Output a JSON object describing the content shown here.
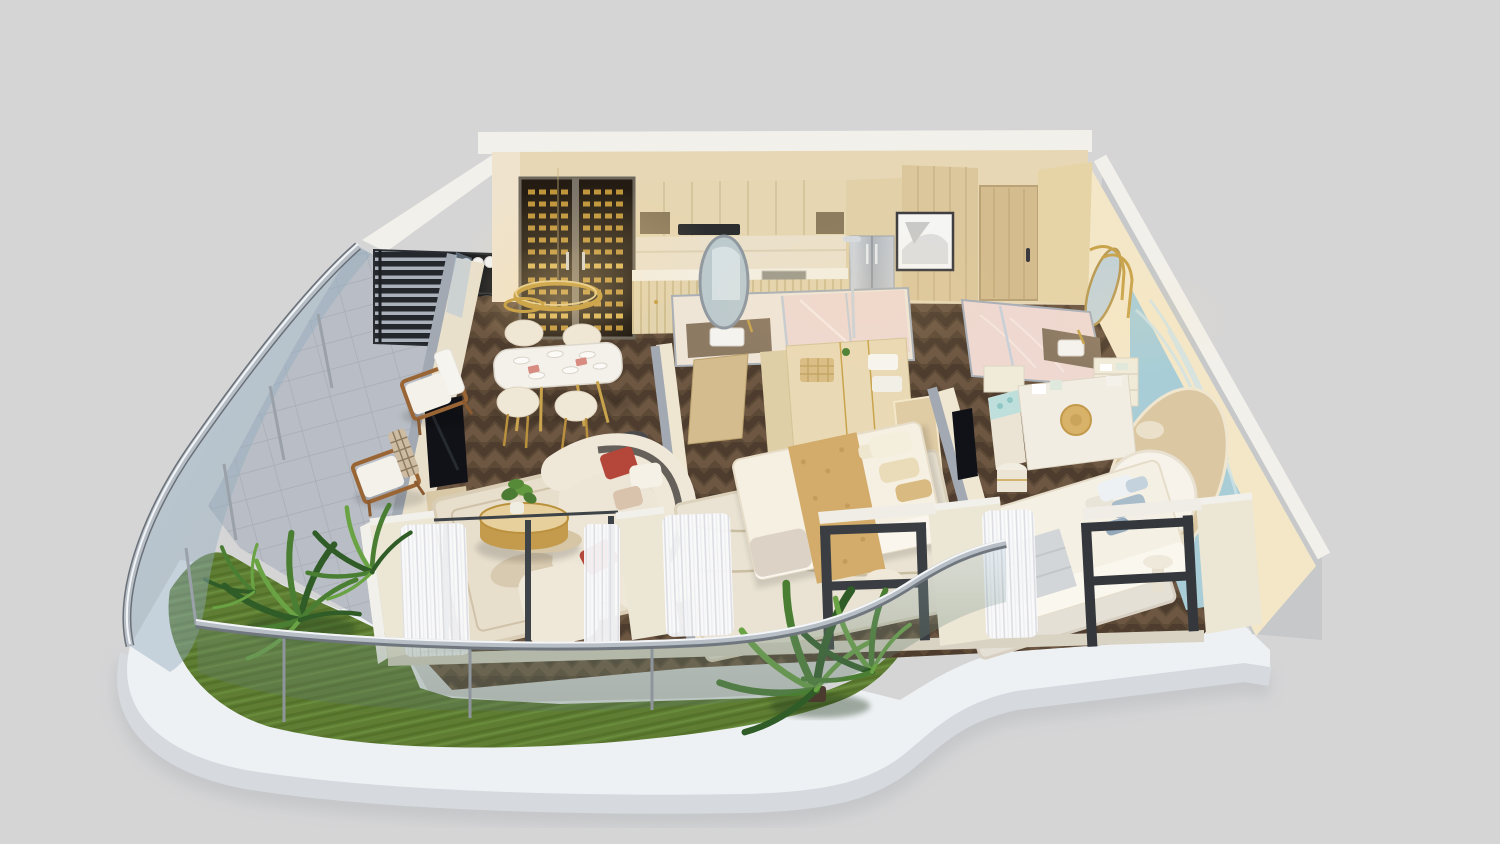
{
  "meta": {
    "title": "Isometric 3D cutaway floor plan render of a two-bedroom apartment with wraparound balcony",
    "canvas": {
      "width": 1500,
      "height": 844
    },
    "style": "photorealistic dollhouse render on plain grey studio background",
    "text_content": "none — image contains no visible text, labels or UI controls"
  },
  "colors": {
    "bg": "#d5d5d6",
    "platform_top": "#eef1f4",
    "platform_face": "#d6dadf",
    "platform_shadow": "#b9bcc0",
    "lawn_green": "#5f7e34",
    "tile_grey": "#b9bdc5",
    "parquet_dark": "#5c4936",
    "parquet_light": "#6d5742",
    "wall_cream": "#ece6d5",
    "wall_cap_grey": "#a3a9b2",
    "wall_top_white": "#f2f0ea",
    "wood_cabinet": "#e6d6b1",
    "wood_door": "#d4bc8e",
    "travertine": "#ebe0ca",
    "wine_gold": "#c89b3c",
    "brass": "#c9a44c",
    "chrome": "#b7bec6",
    "frame_dark": "#3a3d41",
    "glass_blue": "#a7c0d4",
    "sofa_cream": "#efe8d9",
    "accent_rust": "#b5463a",
    "rug_cream": "#e7decc",
    "linen_white": "#f6f0e3",
    "throw_gold": "#d3ac6b",
    "pillow_blue": "#a9bcca",
    "art_blue": "#a8cdd7",
    "art_arch": "#dbc8a2",
    "marble_pink": "#eed8d0",
    "vanity_brown": "#8d7a63",
    "plant_dark": "#2f5c27",
    "plant_mid": "#4a7f33",
    "plant_light": "#69a344",
    "screen_black": "#24282d",
    "tv_black": "#111217",
    "steel": "#c6cbd1"
  },
  "scene": {
    "exterior": {
      "platform": "curved white podium slab with rounded front corner",
      "background": "plain light grey"
    },
    "rooms": [
      {
        "id": "balcony",
        "label": "wraparound balcony",
        "features": [
          "curved glass balustrade with chrome handrail",
          "grey tile deck",
          "artificial lawn strip",
          "fern plants",
          "palm plants",
          "two timber lounge chairs",
          "black slatted privacy screen",
          "outdoor grill station with rolled towels"
        ]
      },
      {
        "id": "kitchen",
        "label": "kitchen",
        "features": [
          "glass wine display cabinet with gold bottle racks",
          "oak upper cabinets with open shelves",
          "cooker hood",
          "travertine backsplash",
          "fluted oak base cabinets with brass knobs",
          "undermount sink",
          "integrated stainless fridge"
        ]
      },
      {
        "id": "dining",
        "label": "dining area",
        "features": [
          "white oval dining table with brass legs",
          "four cream barrel chairs",
          "double gold ring chandelier",
          "plated place settings with coral napkins"
        ]
      },
      {
        "id": "living",
        "label": "living room",
        "features": [
          "curved cream boucle sofa",
          "rust patterned cushions",
          "two-tier brushed gold coffee table with plant",
          "smoked glass side table",
          "wall-mounted tv on stone partition",
          "mottled cream area rug",
          "sheer curtains"
        ]
      },
      {
        "id": "master-bedroom",
        "label": "master bedroom",
        "features": [
          "upholstered bed with gold jacquard throw",
          "beige headboard",
          "open wardrobe shelving with towels and basket",
          "cream wave-pattern rug",
          "round pouf",
          "bronze framed window wall"
        ]
      },
      {
        "id": "master-ensuite",
        "label": "master ensuite",
        "features": [
          "stone double vanity with freestanding oval mirror",
          "pink marble shower with glass screen",
          "chrome rain shower",
          "timber door"
        ]
      },
      {
        "id": "hallway",
        "label": "entry hallway",
        "features": [
          "timber entry door with black handle",
          "framed abstract artwork",
          "wood panelled wall",
          "herringbone floor"
        ]
      },
      {
        "id": "second-bedroom",
        "label": "second bedroom",
        "features": [
          "teal plaster feature wall",
          "arched gilded relief artwork",
          "round white headboard bed",
          "blue-grey pillows",
          "drum nightstand",
          "brass arc floor lamp",
          "wardrobe with round timber handle",
          "bench with teal print cushion",
          "bronze framed window wall",
          "pedestal side table"
        ]
      },
      {
        "id": "second-ensuite",
        "label": "second ensuite",
        "features": [
          "pink marble floor",
          "stone vanity with brass tap",
          "oval brass mirror",
          "linen shelving"
        ]
      }
    ],
    "floors": {
      "interior": "dark herringbone parquet",
      "balcony": "grey tiles plus lawn"
    }
  }
}
